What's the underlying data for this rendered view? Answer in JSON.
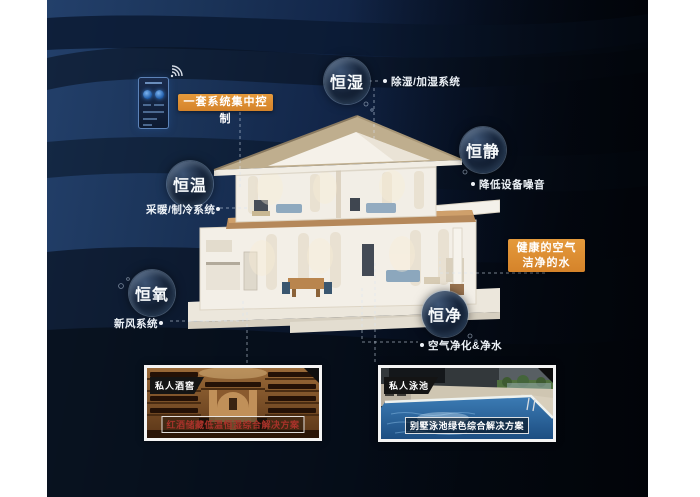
{
  "title": "恒温恒湿智能住宅系统示意图",
  "control": {
    "label": "一套系统集中控制"
  },
  "bubbles": [
    {
      "label": "恒湿",
      "sub": "除湿/加湿系统"
    },
    {
      "label": "恒静",
      "sub": "降低设备噪音"
    },
    {
      "label": "恒温",
      "sub": "采暖/制冷系统"
    },
    {
      "label": "恒氧",
      "sub": "新风系统"
    },
    {
      "label": "恒净",
      "sub": "空气净化&净水"
    }
  ],
  "highlight_box": {
    "line1": "健康的空气",
    "line2": "洁净的水"
  },
  "cards": [
    {
      "tag": "私人酒窖",
      "caption": "红酒储藏低温恒湿综合解决方案"
    },
    {
      "tag": "私人泳池",
      "caption": "别墅泳池绿色综合解决方案"
    }
  ],
  "icons": {
    "wifi": "wifi-icon",
    "panel": "smart-panel-icon"
  },
  "colors": {
    "accent_orange": "#dd8e2f",
    "background_navy": "#16294a",
    "caption_red": "#a8322a",
    "caption_white": "#ffffff",
    "bubble_ring": "#a0bedc"
  }
}
